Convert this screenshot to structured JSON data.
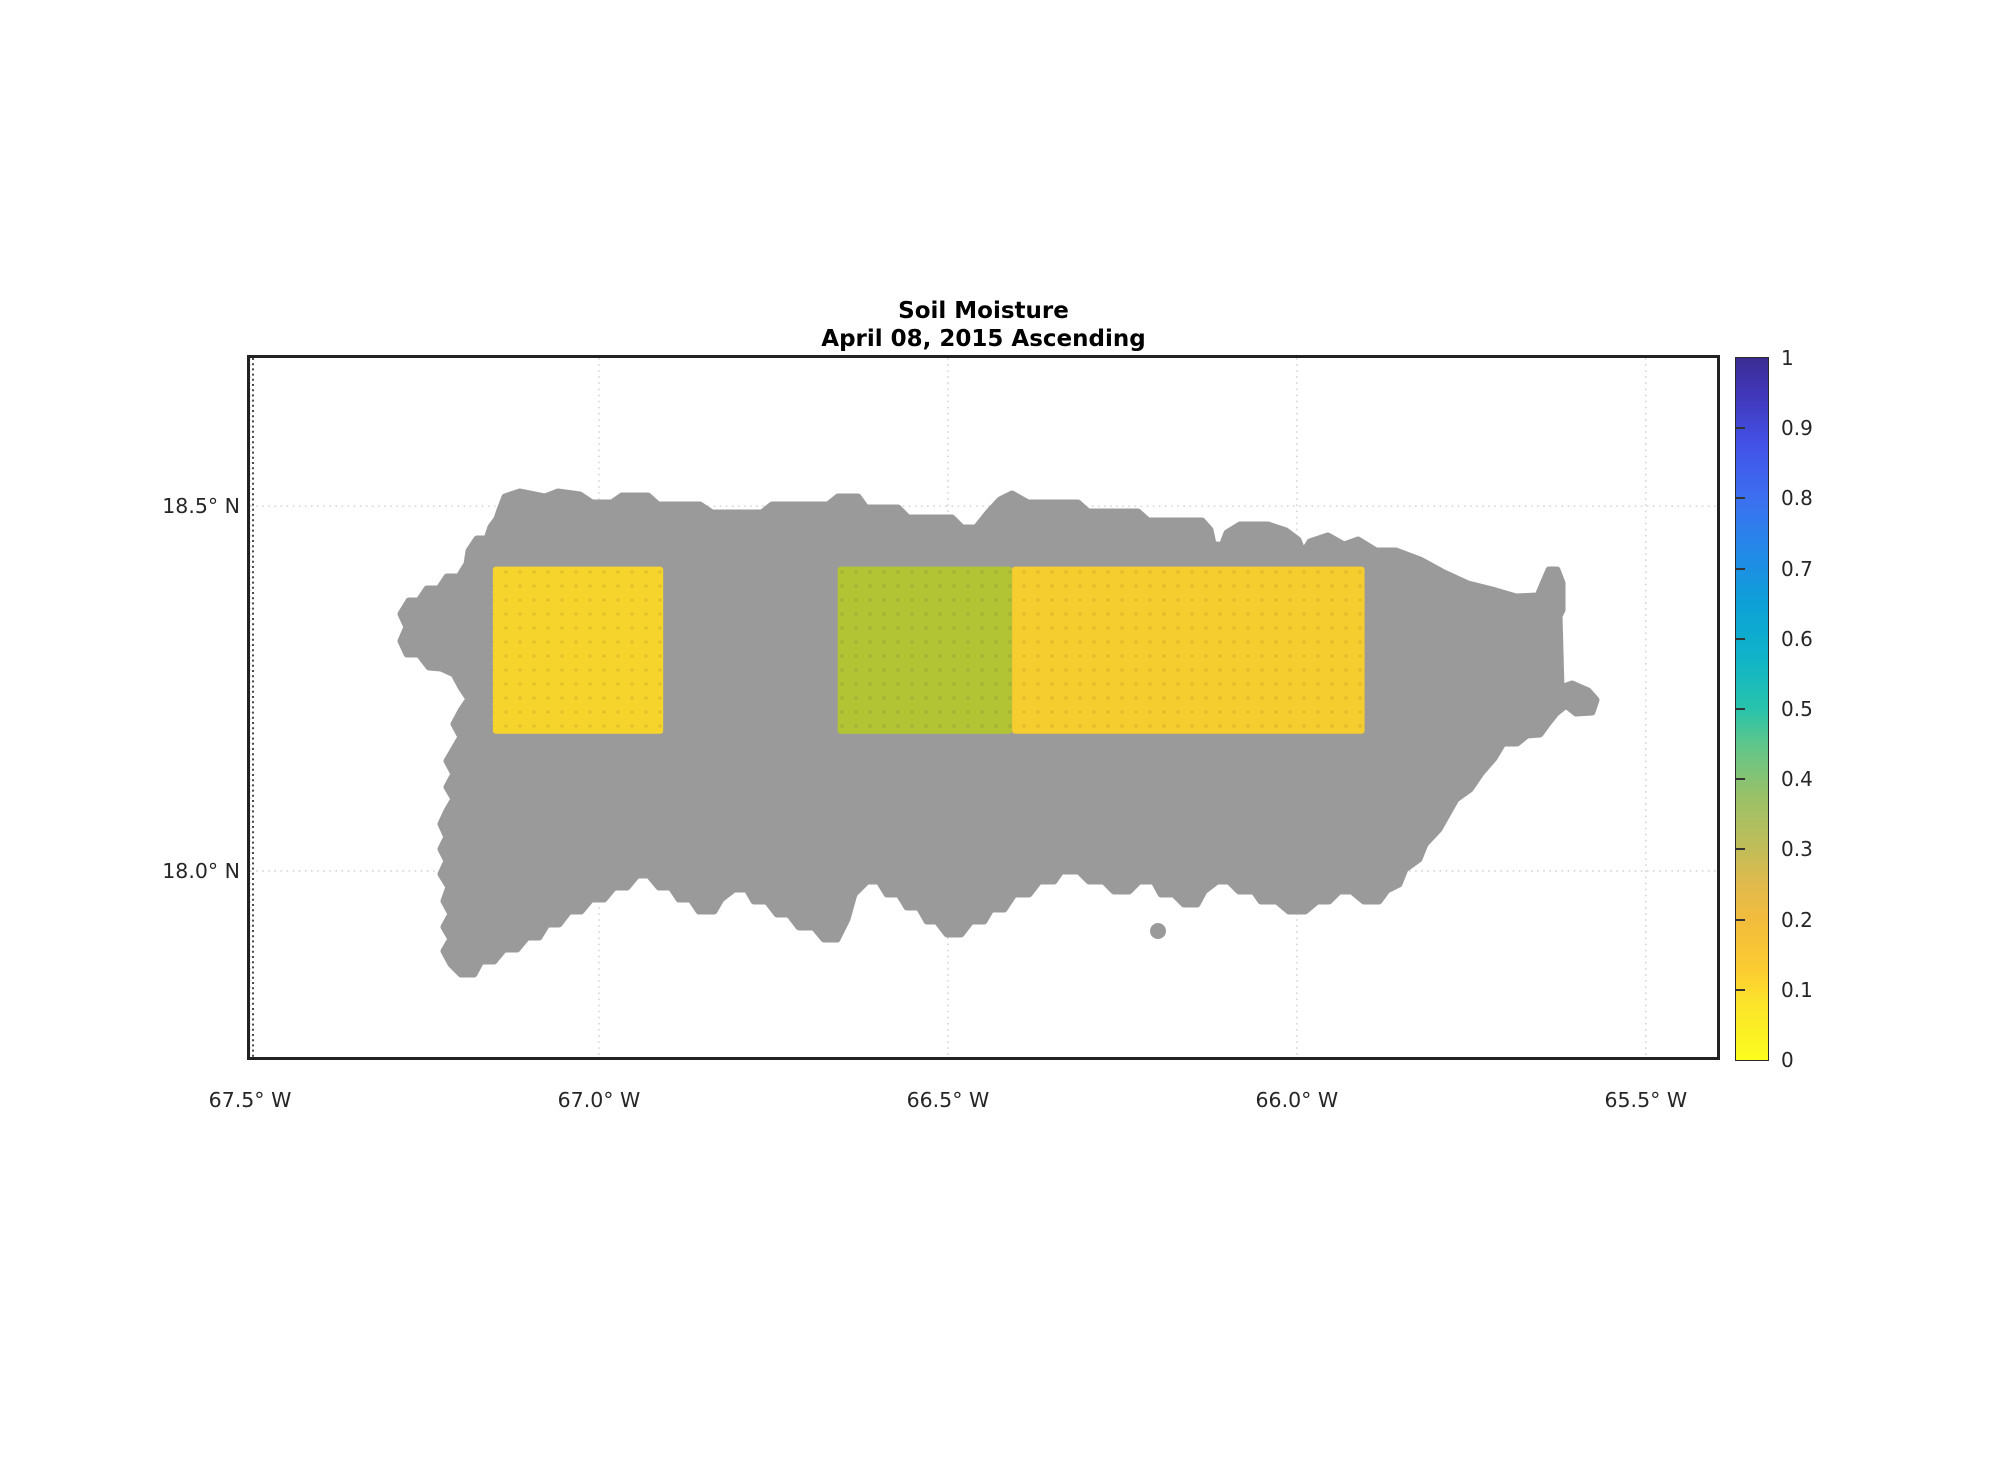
{
  "figure": {
    "title_line1": "Soil Moisture",
    "title_line2": "April 08, 2015 Ascending",
    "background_color": "#ffffff",
    "frame_color": "#222222",
    "grid_color": "#cccccc",
    "text_color": "#262626"
  },
  "chart_data": {
    "type": "heatmap",
    "subtype": "geographic soil-moisture map (satellite swath cells over island)",
    "region": "Puerto Rico",
    "title": "Soil Moisture",
    "subtitle": "April 08, 2015 Ascending",
    "x_axis": {
      "kind": "longitude",
      "ticks": [
        {
          "lon_w": 67.5,
          "label": "67.5° W"
        },
        {
          "lon_w": 67.0,
          "label": "67.0° W"
        },
        {
          "lon_w": 66.5,
          "label": "66.5° W"
        },
        {
          "lon_w": 66.0,
          "label": "66.0° W"
        },
        {
          "lon_w": 65.5,
          "label": "65.5° W"
        }
      ],
      "lim_deg_east": [
        -67.5,
        -65.398
      ]
    },
    "y_axis": {
      "kind": "latitude",
      "ticks": [
        {
          "lat": 18.5,
          "label": "18.5° N"
        },
        {
          "lat": 18.0,
          "label": "18.0° N"
        }
      ],
      "lim_deg_north": [
        17.745,
        18.703
      ]
    },
    "grid": {
      "on": true,
      "line_style": "dotted",
      "color": "#cccccc"
    },
    "land": {
      "label": "island land mass (no retrieval)",
      "color": "#9a9a9a"
    },
    "cells": [
      {
        "name": "west-cell",
        "lon_e_min": -67.152,
        "lon_e_max": -66.908,
        "lat_min": 18.188,
        "lat_max": 18.417,
        "soil_moisture_approx": 0.08,
        "color": "#f7d42b"
      },
      {
        "name": "central-green-cell",
        "lon_e_min": -66.658,
        "lon_e_max": -66.408,
        "lat_min": 18.188,
        "lat_max": 18.417,
        "soil_moisture_approx": 0.28,
        "color": "#b2c334"
      },
      {
        "name": "east-gold-cell",
        "lon_e_min": -66.408,
        "lon_e_max": -65.903,
        "lat_min": 18.188,
        "lat_max": 18.417,
        "soil_moisture_approx": 0.1,
        "color": "#f6cd2e"
      }
    ],
    "colorbar": {
      "min": 0,
      "max": 1,
      "colormap": "parula-flipped (yellow at 0 to dark indigo at 1)",
      "ticks": [
        {
          "v": 0.0,
          "label": "0"
        },
        {
          "v": 0.1,
          "label": "0.1"
        },
        {
          "v": 0.2,
          "label": "0.2"
        },
        {
          "v": 0.3,
          "label": "0.3"
        },
        {
          "v": 0.4,
          "label": "0.4"
        },
        {
          "v": 0.5,
          "label": "0.5"
        },
        {
          "v": 0.6,
          "label": "0.6"
        },
        {
          "v": 0.7,
          "label": "0.7"
        },
        {
          "v": 0.8,
          "label": "0.8"
        },
        {
          "v": 0.9,
          "label": "0.9"
        },
        {
          "v": 1.0,
          "label": "1"
        }
      ],
      "gradient_stops": [
        {
          "p": 0,
          "c": "#fbfc1d"
        },
        {
          "p": 8,
          "c": "#fbe42a"
        },
        {
          "p": 12.5,
          "c": "#fccd31"
        },
        {
          "p": 20,
          "c": "#f2bc3d"
        },
        {
          "p": 25,
          "c": "#e0ba4d"
        },
        {
          "p": 30,
          "c": "#c1bd58"
        },
        {
          "p": 37.5,
          "c": "#9ac167"
        },
        {
          "p": 45,
          "c": "#5ec68b"
        },
        {
          "p": 50,
          "c": "#27c3ab"
        },
        {
          "p": 57.5,
          "c": "#0fb3c9"
        },
        {
          "p": 65,
          "c": "#0da0d6"
        },
        {
          "p": 72.5,
          "c": "#2489e8"
        },
        {
          "p": 80,
          "c": "#3c6ff0"
        },
        {
          "p": 87.5,
          "c": "#4353e8"
        },
        {
          "p": 95,
          "c": "#4136b8"
        },
        {
          "p": 100,
          "c": "#3a2d93"
        }
      ]
    },
    "island_outline_px": [
      [
        500,
        510
      ],
      [
        505,
        497
      ],
      [
        520,
        492
      ],
      [
        545,
        497
      ],
      [
        558,
        492
      ],
      [
        580,
        495
      ],
      [
        592,
        503
      ],
      [
        612,
        503
      ],
      [
        622,
        496
      ],
      [
        648,
        496
      ],
      [
        658,
        505
      ],
      [
        700,
        505
      ],
      [
        712,
        513
      ],
      [
        762,
        513
      ],
      [
        772,
        505
      ],
      [
        828,
        505
      ],
      [
        838,
        497
      ],
      [
        858,
        497
      ],
      [
        866,
        508
      ],
      [
        898,
        508
      ],
      [
        908,
        518
      ],
      [
        952,
        518
      ],
      [
        962,
        528
      ],
      [
        976,
        528
      ],
      [
        988,
        513
      ],
      [
        1000,
        500
      ],
      [
        1012,
        494
      ],
      [
        1028,
        503
      ],
      [
        1078,
        503
      ],
      [
        1088,
        512
      ],
      [
        1138,
        512
      ],
      [
        1148,
        521
      ],
      [
        1202,
        521
      ],
      [
        1210,
        530
      ],
      [
        1213,
        544
      ],
      [
        1222,
        546
      ],
      [
        1227,
        533
      ],
      [
        1240,
        525
      ],
      [
        1268,
        525
      ],
      [
        1286,
        531
      ],
      [
        1298,
        540
      ],
      [
        1303,
        553
      ],
      [
        1310,
        542
      ],
      [
        1328,
        536
      ],
      [
        1344,
        545
      ],
      [
        1358,
        540
      ],
      [
        1376,
        551
      ],
      [
        1396,
        551
      ],
      [
        1420,
        560
      ],
      [
        1442,
        572
      ],
      [
        1468,
        584
      ],
      [
        1492,
        590
      ],
      [
        1516,
        597
      ],
      [
        1538,
        596
      ],
      [
        1543,
        584
      ],
      [
        1549,
        570
      ],
      [
        1557,
        570
      ],
      [
        1562,
        583
      ],
      [
        1562,
        610
      ],
      [
        1559,
        616
      ],
      [
        1561,
        688
      ],
      [
        1572,
        684
      ],
      [
        1588,
        691
      ],
      [
        1596,
        700
      ],
      [
        1592,
        712
      ],
      [
        1576,
        713
      ],
      [
        1566,
        705
      ],
      [
        1556,
        713
      ],
      [
        1548,
        723
      ],
      [
        1540,
        734
      ],
      [
        1527,
        735
      ],
      [
        1517,
        743
      ],
      [
        1503,
        743
      ],
      [
        1494,
        758
      ],
      [
        1481,
        773
      ],
      [
        1470,
        789
      ],
      [
        1456,
        799
      ],
      [
        1448,
        813
      ],
      [
        1439,
        829
      ],
      [
        1425,
        844
      ],
      [
        1419,
        859
      ],
      [
        1405,
        869
      ],
      [
        1399,
        884
      ],
      [
        1387,
        890
      ],
      [
        1379,
        901
      ],
      [
        1364,
        901
      ],
      [
        1352,
        891
      ],
      [
        1339,
        891
      ],
      [
        1329,
        901
      ],
      [
        1317,
        901
      ],
      [
        1305,
        911
      ],
      [
        1289,
        911
      ],
      [
        1277,
        901
      ],
      [
        1261,
        901
      ],
      [
        1254,
        891
      ],
      [
        1239,
        891
      ],
      [
        1229,
        881
      ],
      [
        1217,
        881
      ],
      [
        1204,
        891
      ],
      [
        1197,
        904
      ],
      [
        1184,
        904
      ],
      [
        1174,
        894
      ],
      [
        1161,
        894
      ],
      [
        1154,
        881
      ],
      [
        1139,
        881
      ],
      [
        1129,
        891
      ],
      [
        1114,
        891
      ],
      [
        1104,
        881
      ],
      [
        1089,
        881
      ],
      [
        1079,
        871
      ],
      [
        1061,
        871
      ],
      [
        1054,
        881
      ],
      [
        1039,
        881
      ],
      [
        1029,
        894
      ],
      [
        1014,
        894
      ],
      [
        1004,
        909
      ],
      [
        991,
        909
      ],
      [
        984,
        921
      ],
      [
        971,
        921
      ],
      [
        961,
        934
      ],
      [
        947,
        934
      ],
      [
        937,
        921
      ],
      [
        927,
        921
      ],
      [
        919,
        907
      ],
      [
        907,
        907
      ],
      [
        899,
        894
      ],
      [
        887,
        894
      ],
      [
        879,
        881
      ],
      [
        867,
        881
      ],
      [
        854,
        894
      ],
      [
        847,
        919
      ],
      [
        837,
        939
      ],
      [
        824,
        939
      ],
      [
        814,
        927
      ],
      [
        799,
        927
      ],
      [
        789,
        914
      ],
      [
        777,
        914
      ],
      [
        767,
        901
      ],
      [
        754,
        901
      ],
      [
        747,
        889
      ],
      [
        734,
        889
      ],
      [
        721,
        899
      ],
      [
        714,
        911
      ],
      [
        699,
        911
      ],
      [
        691,
        899
      ],
      [
        679,
        899
      ],
      [
        671,
        887
      ],
      [
        659,
        887
      ],
      [
        649,
        875
      ],
      [
        637,
        875
      ],
      [
        627,
        887
      ],
      [
        614,
        887
      ],
      [
        604,
        899
      ],
      [
        591,
        899
      ],
      [
        581,
        911
      ],
      [
        569,
        911
      ],
      [
        559,
        924
      ],
      [
        547,
        924
      ],
      [
        539,
        937
      ],
      [
        527,
        937
      ],
      [
        517,
        949
      ],
      [
        504,
        949
      ],
      [
        494,
        961
      ],
      [
        481,
        961
      ],
      [
        474,
        974
      ],
      [
        461,
        974
      ],
      [
        451,
        964
      ],
      [
        444,
        951
      ],
      [
        451,
        939
      ],
      [
        444,
        927
      ],
      [
        451,
        914
      ],
      [
        444,
        901
      ],
      [
        449,
        887
      ],
      [
        441,
        874
      ],
      [
        447,
        861
      ],
      [
        441,
        849
      ],
      [
        447,
        837
      ],
      [
        441,
        824
      ],
      [
        447,
        811
      ],
      [
        454,
        799
      ],
      [
        447,
        787
      ],
      [
        454,
        774
      ],
      [
        447,
        761
      ],
      [
        454,
        749
      ],
      [
        461,
        737
      ],
      [
        454,
        724
      ],
      [
        461,
        711
      ],
      [
        469,
        699
      ],
      [
        461,
        687
      ],
      [
        454,
        674
      ],
      [
        441,
        668
      ],
      [
        429,
        667
      ],
      [
        419,
        654
      ],
      [
        407,
        654
      ],
      [
        401,
        641
      ],
      [
        407,
        627
      ],
      [
        401,
        614
      ],
      [
        409,
        601
      ],
      [
        419,
        601
      ],
      [
        427,
        589
      ],
      [
        439,
        589
      ],
      [
        447,
        577
      ],
      [
        459,
        577
      ],
      [
        467,
        564
      ],
      [
        469,
        551
      ],
      [
        477,
        539
      ],
      [
        487,
        539
      ],
      [
        491,
        527
      ],
      [
        497,
        519
      ]
    ],
    "offshore_islet_px": {
      "cx": 1158,
      "cy": 931,
      "r": 8
    }
  },
  "geometry": {
    "plot": {
      "x": 250,
      "y": 358,
      "w": 1467,
      "h": 699
    },
    "colorbar": {
      "x": 1736,
      "y": 358,
      "w": 32,
      "h": 702
    }
  }
}
